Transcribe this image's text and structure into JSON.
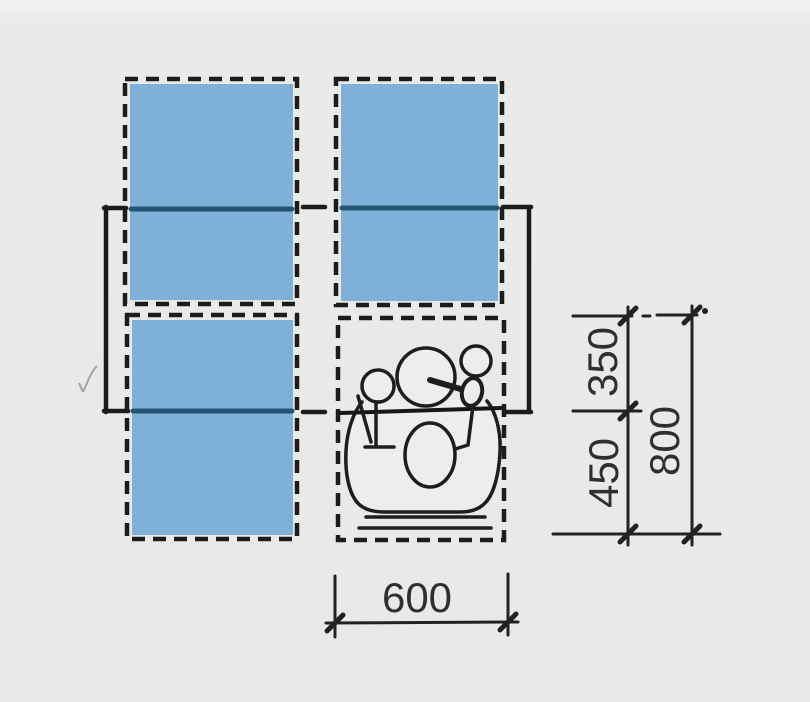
{
  "diagram": {
    "name": "dining-table-workspace-plan-diagram",
    "description": "Top view plan of a table with four seating places; one place occupied by a seated person; dimension lines give required space per seat",
    "dimensions": {
      "depth_on_table": "350",
      "depth_for_chair": "450",
      "depth_total": "800",
      "width_per_seat": "600"
    },
    "colors": {
      "background": "#e8eae8",
      "seat_zone_fill": "#7fb0d8",
      "outline": "#1b1b1b",
      "table_edge_through_fill": "#235572",
      "dimension_text": "#2f2f2f"
    }
  }
}
